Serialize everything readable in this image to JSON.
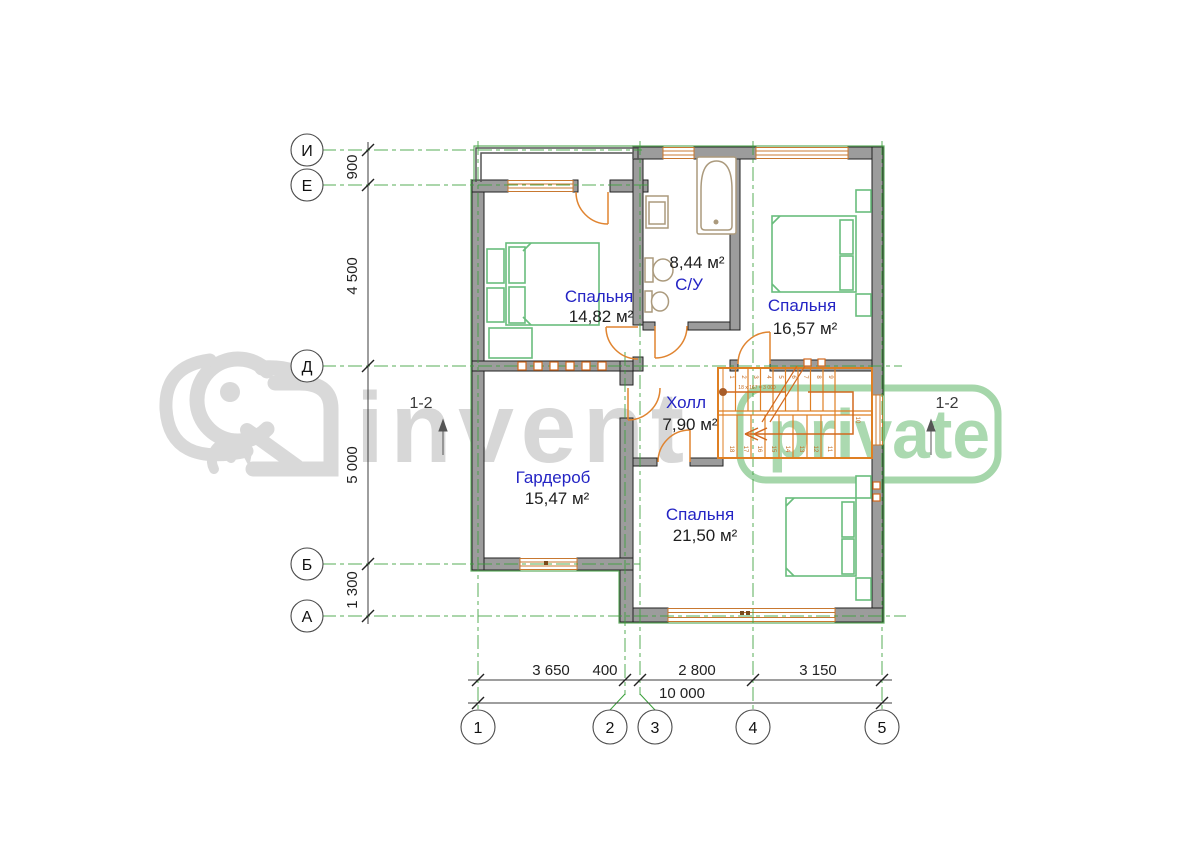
{
  "plan": {
    "axes": {
      "horizontal": [
        "И",
        "Е",
        "Д",
        "Б",
        "А"
      ],
      "vertical": [
        "1",
        "2",
        "3",
        "4",
        "5"
      ]
    },
    "dimensions": {
      "left": [
        "900",
        "4 500",
        "5 000",
        "1 300"
      ],
      "bottom": [
        "3 650",
        "400",
        "2 800",
        "3 150"
      ],
      "total": "10 000"
    },
    "rooms": [
      {
        "name": "Спальня",
        "area": "14,82 м²"
      },
      {
        "name": "С/У",
        "area": "8,44 м²"
      },
      {
        "name": "Спальня",
        "area": "16,57 м²"
      },
      {
        "name": "Холл",
        "area": "7,90 м²"
      },
      {
        "name": "Гардероб",
        "area": "15,47 м²"
      },
      {
        "name": "Спальня",
        "area": "21,50 м²"
      }
    ],
    "section_marker_left": "1-2",
    "section_marker_right": "1-2",
    "stairs": {
      "formula": "18 x 167 = 3 000",
      "up": [
        "1",
        "2",
        "3",
        "4",
        "5",
        "6",
        "7",
        "8",
        "9"
      ],
      "landing": "10",
      "down": [
        "18",
        "17",
        "16",
        "15",
        "14",
        "13",
        "12",
        "11"
      ]
    }
  },
  "watermark": {
    "brand": "invent",
    "badge": "private"
  },
  "colors": {
    "wall_fill": "#9c9c9c",
    "outline": "#222222",
    "grid_green": "#3aa03a",
    "accent_orange": "#df7f23",
    "furniture_green": "#69bd7d",
    "fixture_tan": "#ab9a7d",
    "label_blue": "#2424c4",
    "watermark_gray": "#d7d7d7",
    "watermark_green": "#a5d6aa"
  }
}
